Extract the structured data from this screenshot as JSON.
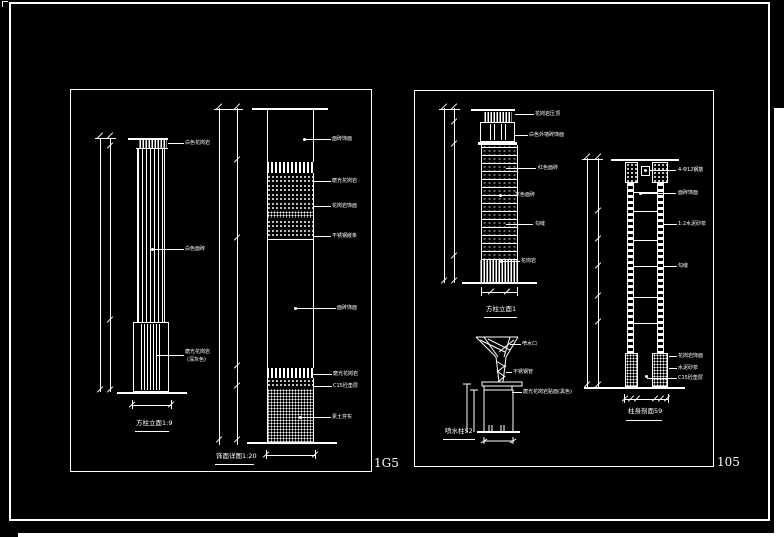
{
  "canvas": {
    "background": "#000000",
    "ink": "#ffffff"
  },
  "frame": {
    "left_page_number": "1G5",
    "right_page_number": "105"
  },
  "left_panel": {
    "column": {
      "title": "方柱立面1:9",
      "labels": [
        "白色花岗岩",
        "白色面砖",
        "磨光花岗岩",
        "(深灰色)"
      ]
    },
    "strip": {
      "title": "饰面详图1:20",
      "labels": [
        "面砖饰面",
        "磨光花岗岩",
        "花岗岩饰面",
        "不锈钢嵌条",
        "面砖饰面",
        "磨光花岗岩",
        "C15砼垫层",
        "素土夯实"
      ]
    }
  },
  "right_panel": {
    "column": {
      "title": "方柱立面1",
      "labels": [
        "花岗岩压顶",
        "白色外墙砖饰面",
        "红色面砖",
        "灰色面砖",
        "勾缝",
        "花岗岩"
      ]
    },
    "fountain": {
      "title": "喷水柱52",
      "labels": [
        "喷水口",
        "不锈钢管",
        "磨光花岗岩贴面(黑色)"
      ]
    },
    "section": {
      "title": "柱身剖面59",
      "labels": [
        "4-Φ12钢筋",
        "面砖饰面",
        "1:2水泥砂浆",
        "勾缝",
        "花岗岩饰面",
        "水泥砂浆",
        "C15砼垫层"
      ]
    }
  }
}
